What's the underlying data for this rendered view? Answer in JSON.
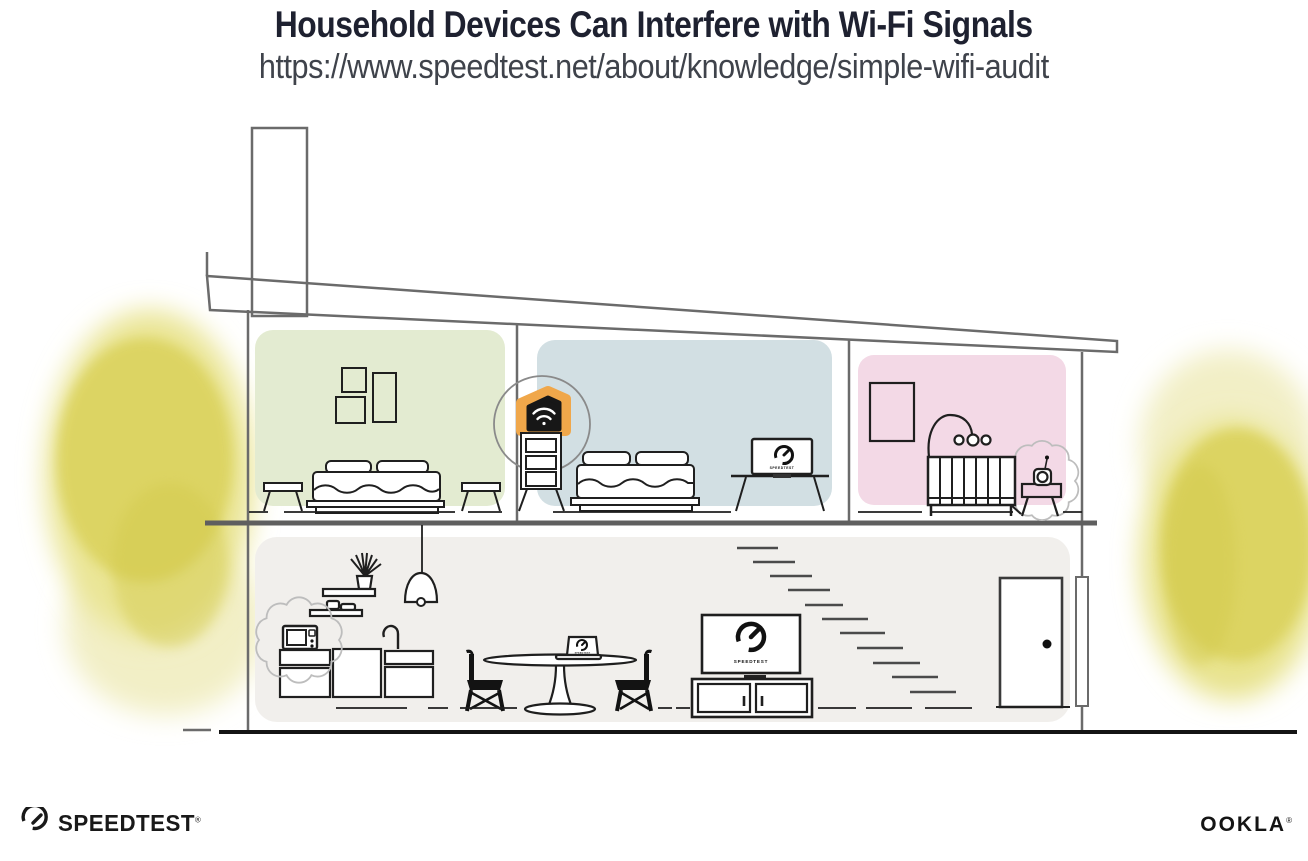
{
  "header": {
    "title": "Household Devices Can Interfere with Wi-Fi Signals",
    "url": "https://www.speedtest.net/about/knowledge/simple-wifi-audit"
  },
  "illustration": {
    "screens": {
      "bedroom_monitor_label": "SPEEDTEST",
      "living_room_tv_label": "SPEEDTEST",
      "dining_laptop_label": "SPEEDTEST"
    },
    "colors": {
      "wall_green": "#e3ebd1",
      "wall_blue": "#d2dfe3",
      "wall_pink": "#f3d9e6",
      "floor_gray": "#f1efec",
      "router_orange": "#f0a74a",
      "foliage_yellow": "#dcd45f",
      "structure_gray": "#6b6b6b",
      "ink_black": "#1f1f1f",
      "title_navy": "#1e2130"
    }
  },
  "footer": {
    "speedtest_label": "SPEEDTEST",
    "speedtest_registered": "®",
    "ookla_label": "OOKLA",
    "ookla_registered": "®"
  }
}
